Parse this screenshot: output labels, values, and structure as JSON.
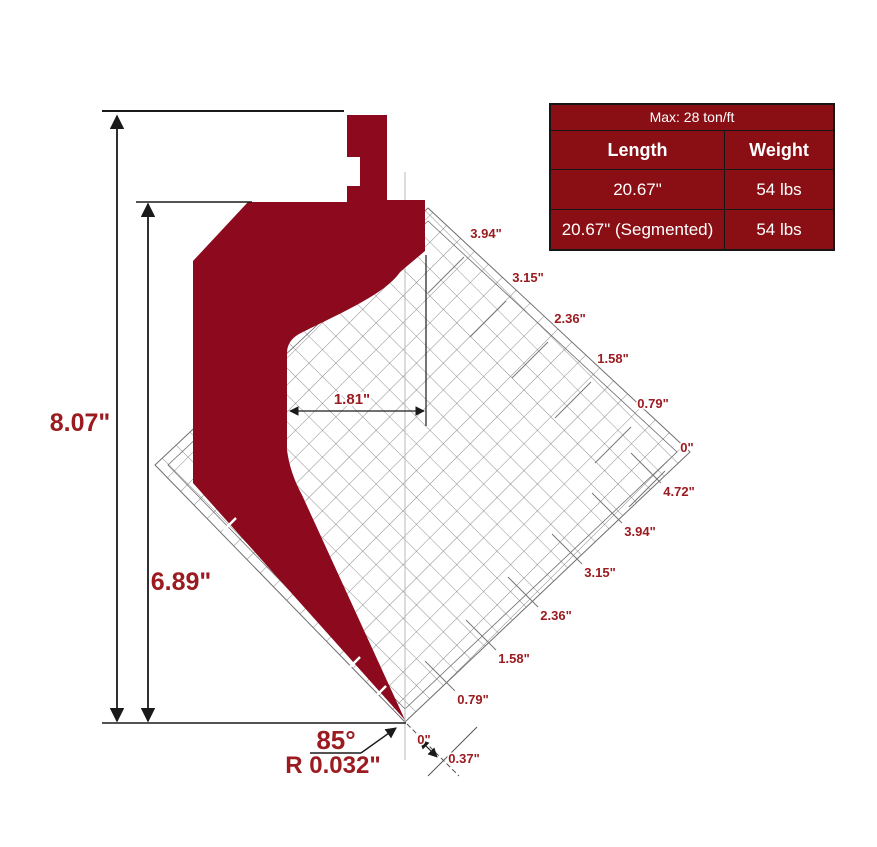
{
  "table": {
    "title": "Max: 28 ton/ft",
    "columns": [
      "Length",
      "Weight"
    ],
    "rows": [
      {
        "length": "20.67\"",
        "weight": "54 lbs"
      },
      {
        "length": "20.67\" (Segmented)",
        "weight": "54 lbs"
      }
    ]
  },
  "dimensions": {
    "overall_height": "8.07\"",
    "working_height": "6.89\"",
    "throat_depth": "1.81\"",
    "tip_angle": "85°",
    "tip_radius": "R 0.032\"",
    "zero_mark": "0\"",
    "tip_offset": "0.37\""
  },
  "rulers": {
    "upper": [
      "3.94\"",
      "3.15\"",
      "2.36\"",
      "1.58\"",
      "0.79\"",
      "0\""
    ],
    "lower": [
      "4.72\"",
      "3.94\"",
      "3.15\"",
      "2.36\"",
      "1.58\"",
      "0.79\""
    ]
  },
  "colors": {
    "punch": "#8D0A1E",
    "table_bg": "#8A0F14",
    "dimension_text": "#9B1B20",
    "line": "#1a1a1a",
    "grid_line": "#6e6e6e"
  }
}
